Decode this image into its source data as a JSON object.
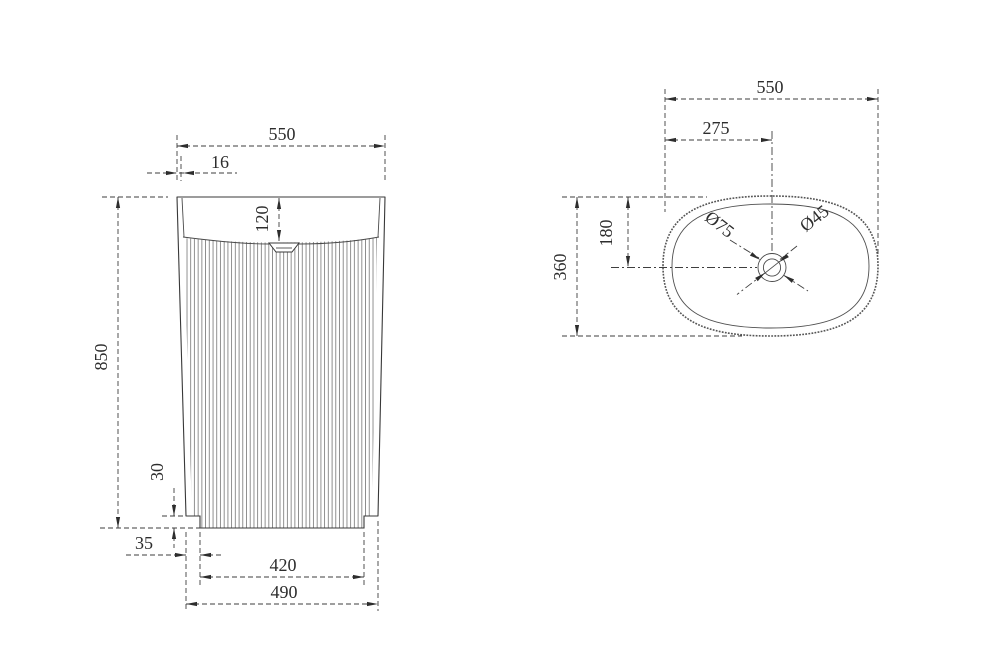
{
  "drawing": {
    "type": "technical-dimension-drawing",
    "subject": "freestanding fluted pedestal basin",
    "units": "mm",
    "front_view": {
      "overall_width": "550",
      "rim_wall_thickness": "16",
      "basin_depth": "120",
      "overall_height": "850",
      "base_recess_height": "30",
      "base_side_offset": "35",
      "base_inner_width": "420",
      "base_outer_width": "490"
    },
    "top_view": {
      "overall_width": "550",
      "drain_center_from_left": "275",
      "overall_depth": "360",
      "drain_center_from_top": "180",
      "waste_outer_diameter": "Ø75",
      "waste_inner_diameter": "Ø45"
    },
    "colors": {
      "line": "#3e3e3e",
      "outline": "#383838",
      "background": "#ffffff"
    }
  }
}
